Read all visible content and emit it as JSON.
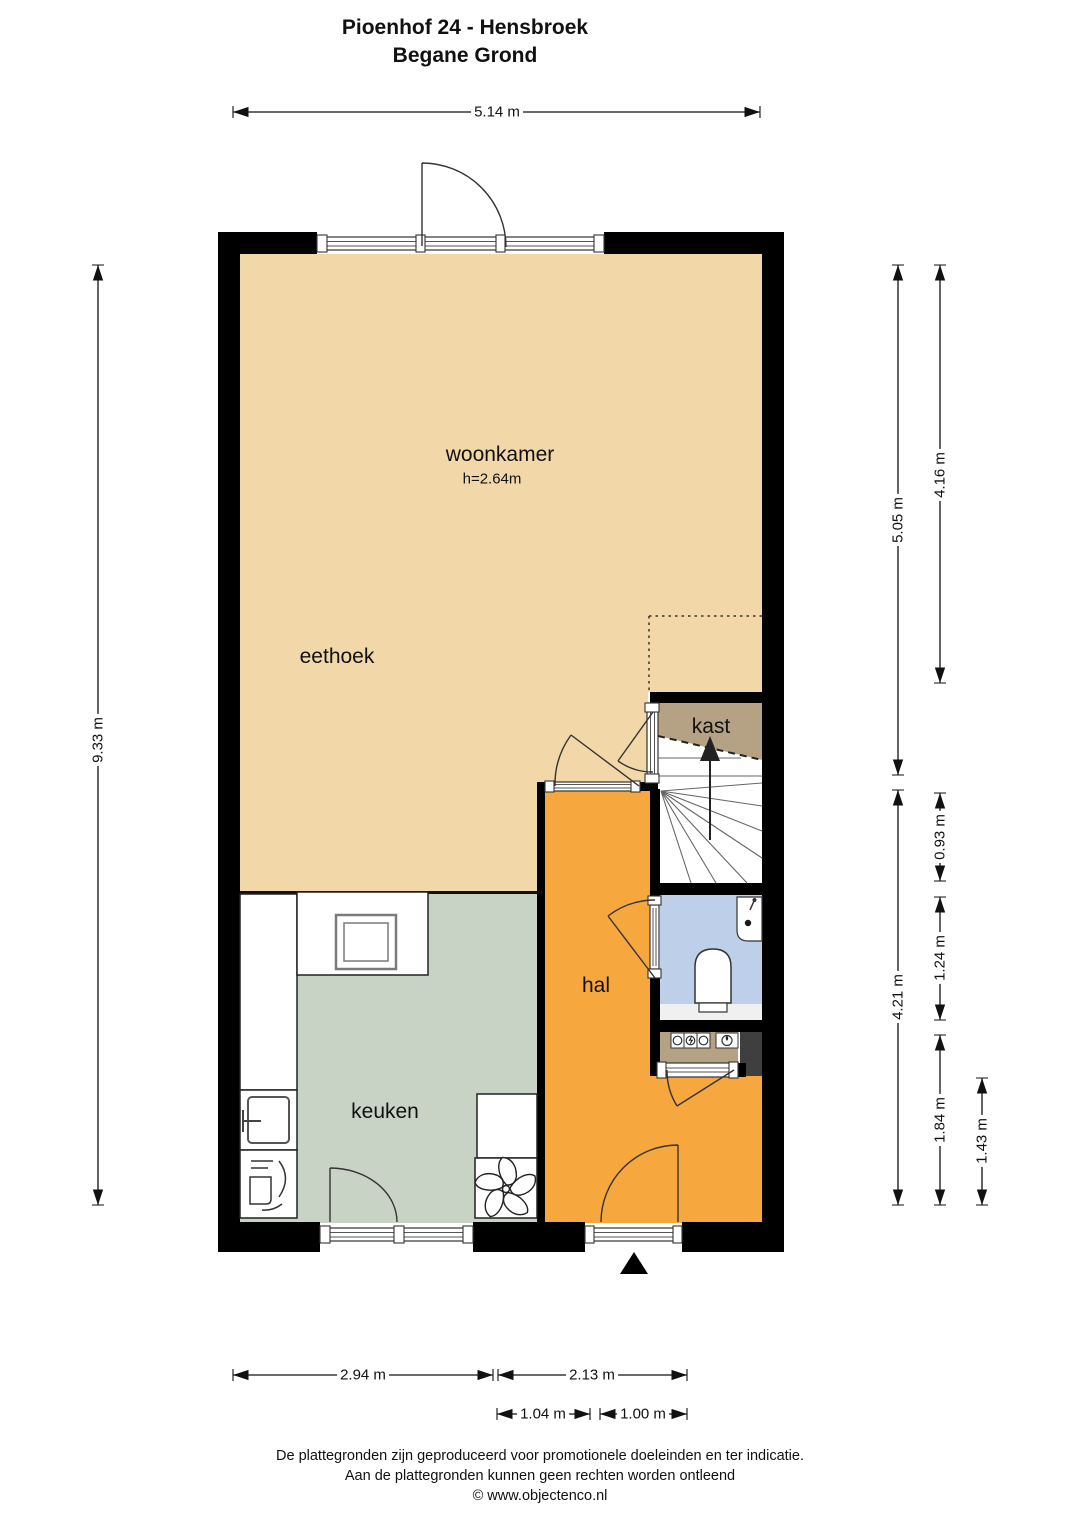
{
  "title": {
    "line1": "Pioenhof 24 - Hensbroek",
    "line2": "Begane Grond"
  },
  "rooms": {
    "woonkamer": {
      "label": "woonkamer",
      "ceiling_height": "h=2.64m"
    },
    "eethoek": {
      "label": "eethoek"
    },
    "keuken": {
      "label": "keuken"
    },
    "hal": {
      "label": "hal"
    },
    "kast": {
      "label": "kast"
    }
  },
  "dimensions": {
    "top_width": "5.14 m",
    "left_height": "9.33 m",
    "right_upper_inner": "5.05 m",
    "right_upper_outer": "4.16 m",
    "right_closet": "0.93 m",
    "right_toilet": "1.24 m",
    "right_lower": "4.21 m",
    "right_hal": "1.84 m",
    "right_entry": "1.43 m",
    "bottom_kitchen": "2.94 m",
    "bottom_hall": "2.13 m",
    "bottom_kitchen_door": "1.04 m",
    "bottom_front_door": "1.00 m"
  },
  "footer": {
    "line1": "De plattegronden zijn geproduceerd voor promotionele doeleinden en ter indicatie.",
    "line2": "Aan de plattegronden kunnen geen rechten worden ontleend",
    "line3": "© www.objectenco.nl"
  },
  "colors": {
    "wall": "#000000",
    "living_floor": "#f2d8a9",
    "kitchen_floor": "#c9d3c5",
    "hall_floor": "#f6a83f",
    "closet_floor": "#b5a284",
    "toilet_floor": "#bdcfe9",
    "stair_floor": "#ffffff",
    "duct": "#3f3f3f"
  },
  "icons": {
    "entrance_marker": "filled-triangle-up",
    "stairs_direction": "arrow-up",
    "toilet": "toilet-bowl",
    "corner_sink": "fontein",
    "kitchen_sink": "sink-basin",
    "hob": "cooktop-square",
    "ventilation": "fan-star",
    "meters": "utility-meters"
  }
}
